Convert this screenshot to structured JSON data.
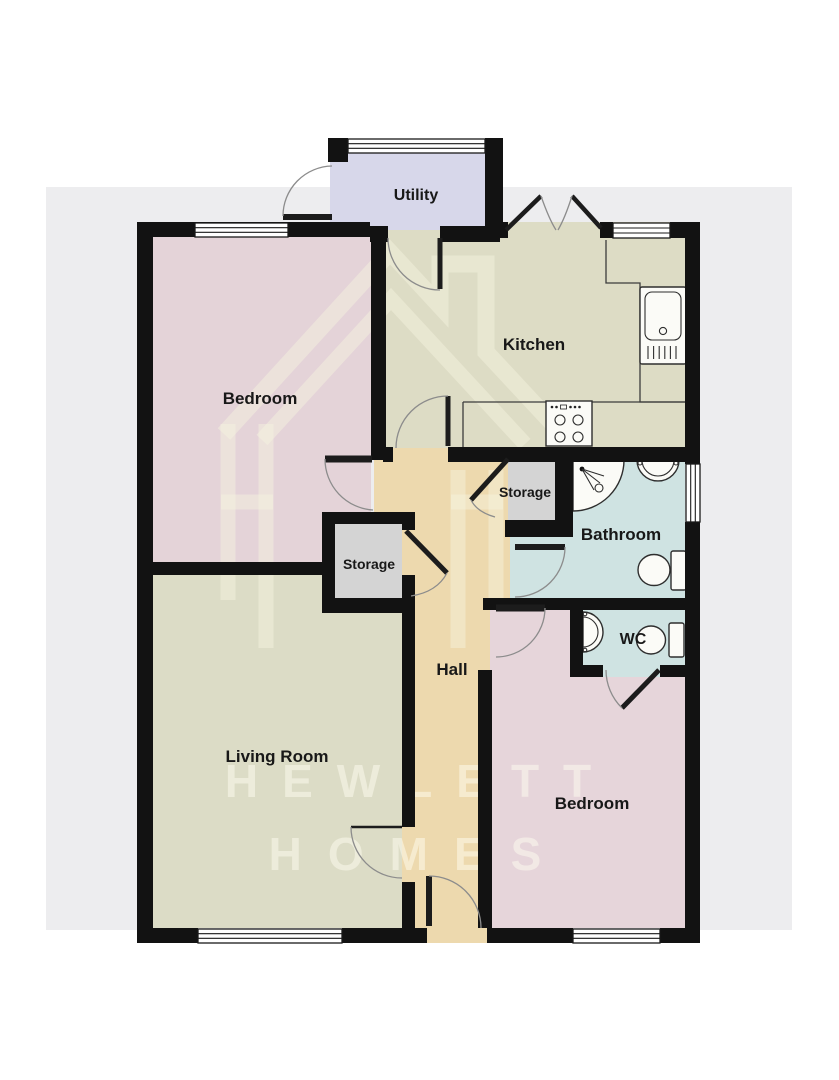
{
  "page": {
    "backdrop_color": "#EDEDEF",
    "wall_color": "#121212"
  },
  "floorplan": {
    "watermark": {
      "line1": "HEWLETT",
      "line2": "HOMES"
    },
    "rooms": [
      {
        "id": "utility",
        "label": "Utility",
        "color": "#D7D7EA"
      },
      {
        "id": "kitchen",
        "label": "Kitchen",
        "color": "#DDDCC5"
      },
      {
        "id": "bedroom-top",
        "label": "Bedroom",
        "color": "#E4D3D8"
      },
      {
        "id": "storage-left",
        "label": "Storage",
        "color": "#D4D4D4"
      },
      {
        "id": "storage-right",
        "label": "Storage",
        "color": "#D4D4D4"
      },
      {
        "id": "bathroom",
        "label": "Bathroom",
        "color": "#CFE3E2"
      },
      {
        "id": "wc",
        "label": "WC",
        "color": "#CFE3E2"
      },
      {
        "id": "hall",
        "label": "Hall",
        "color": "#EDD9AE"
      },
      {
        "id": "living-room",
        "label": "Living Room",
        "color": "#DCDCC6"
      },
      {
        "id": "bedroom-bottom",
        "label": "Bedroom",
        "color": "#E6D5DA"
      }
    ]
  }
}
